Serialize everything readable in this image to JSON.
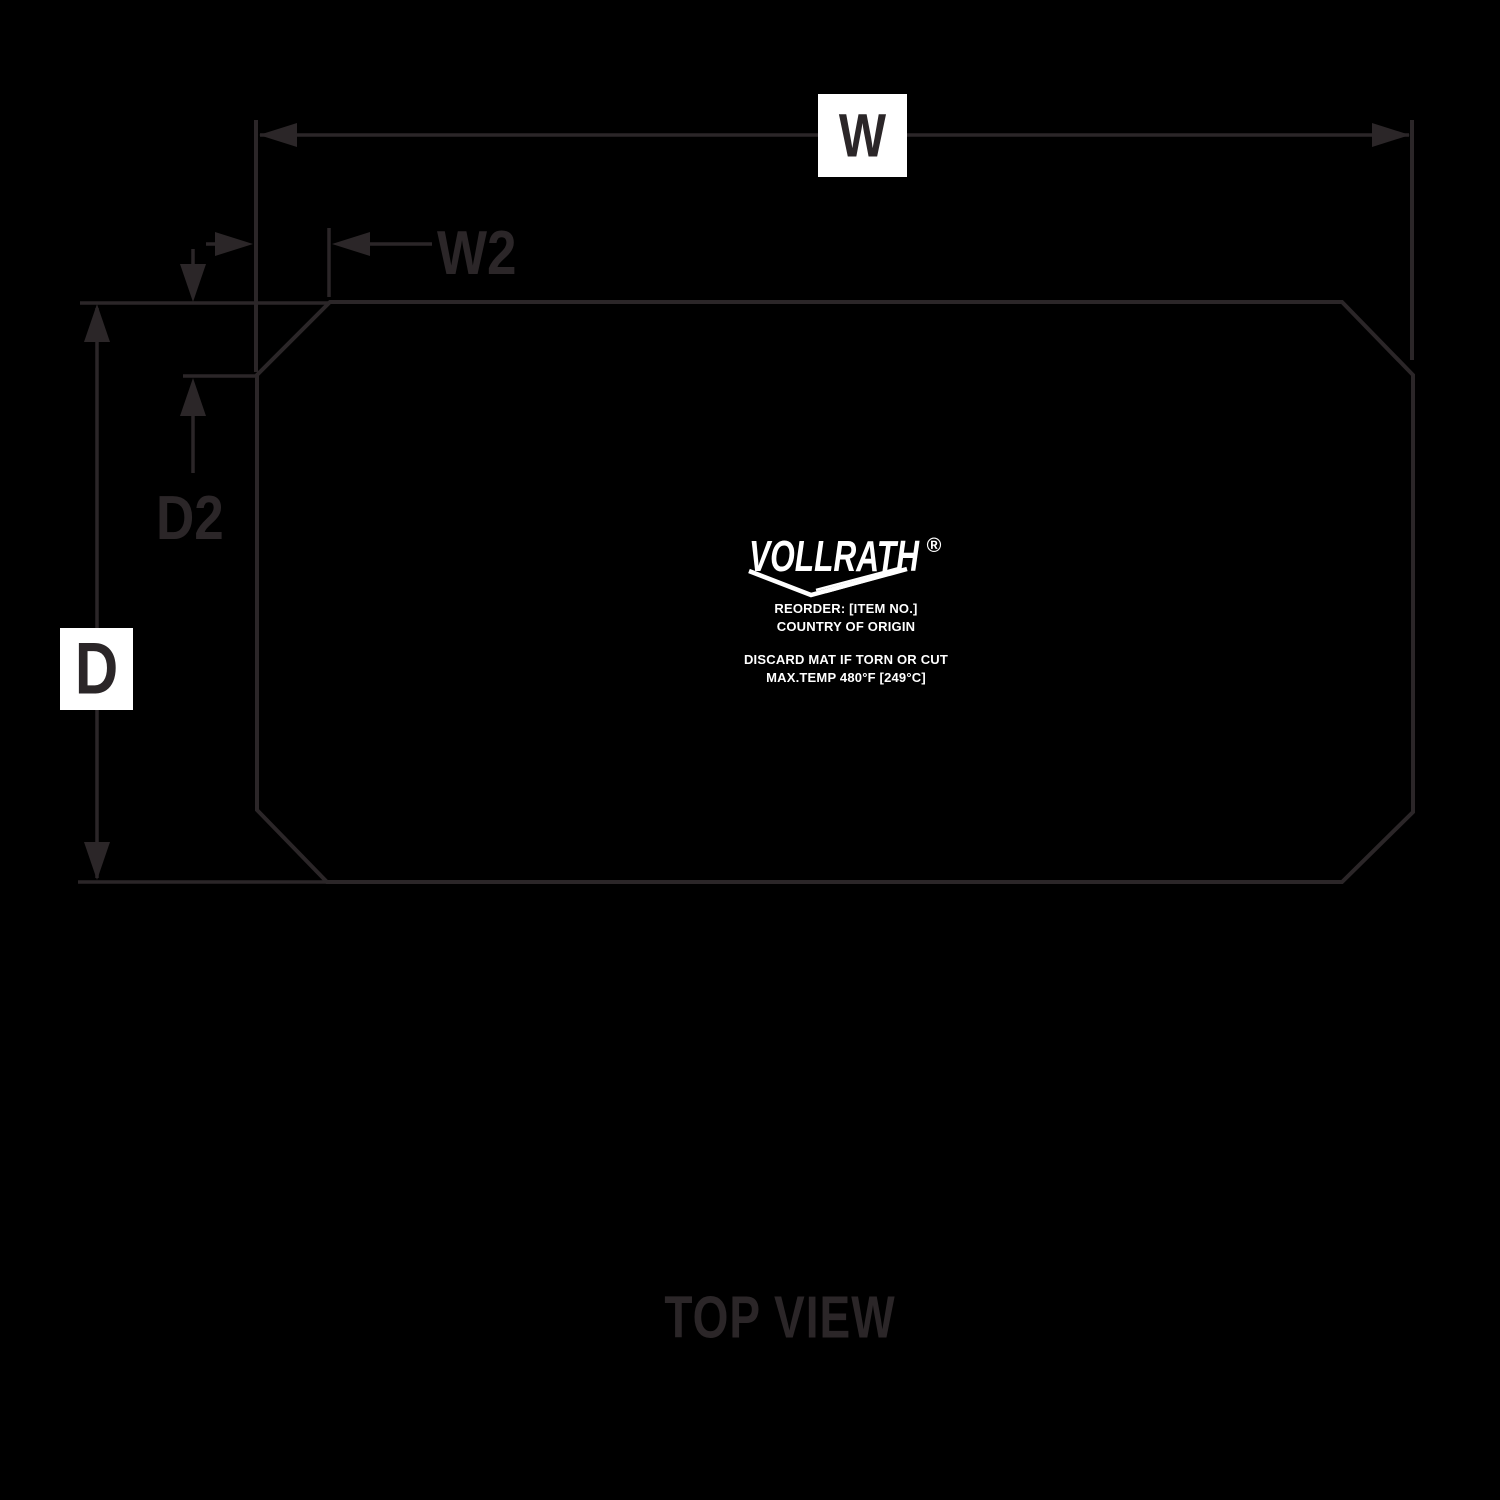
{
  "colors": {
    "background": "#000000",
    "line": "#2b2628",
    "label_box": "#ffffff",
    "mat_print": "#ffffff"
  },
  "dimension_labels": {
    "width": "W",
    "width_corner": "W2",
    "depth": "D",
    "depth_corner": "D2"
  },
  "mat_print": {
    "logo_text": "VOLLRATH",
    "registered_mark": "®",
    "reorder_line": "REORDER: [ITEM NO.]",
    "origin_line": "COUNTRY OF ORIGIN",
    "discard_line": "DISCARD MAT IF TORN OR CUT",
    "max_temp_line": "MAX.TEMP 480°F [249°C]"
  },
  "caption": {
    "text": "TOP VIEW"
  }
}
